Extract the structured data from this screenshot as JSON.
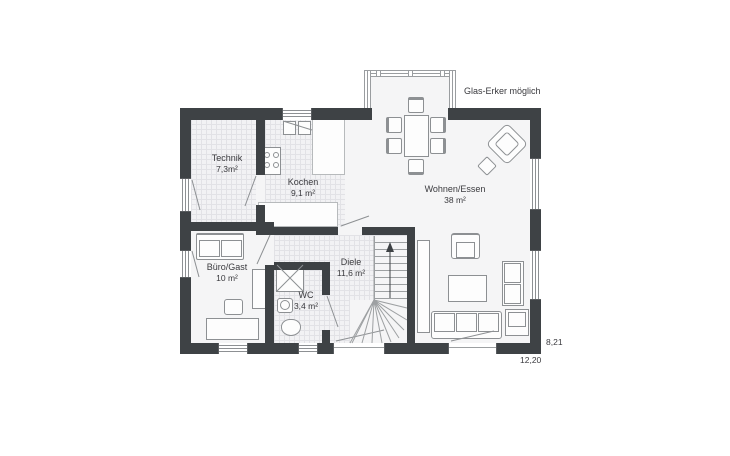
{
  "annotations": {
    "glas_erker_label": "Glas-Erker möglich",
    "dim_height": "8,21",
    "dim_width": "12,20"
  },
  "rooms": [
    {
      "name": "Technik",
      "area": "7,3m²"
    },
    {
      "name": "Kochen",
      "area": "9,1 m²"
    },
    {
      "name": "Wohnen/Essen",
      "area": "38 m²"
    },
    {
      "name": "Büro/Gast",
      "area": "10 m²"
    },
    {
      "name": "Diele",
      "area": "11,6 m²"
    },
    {
      "name": "WC",
      "area": "3,4 m²"
    }
  ],
  "colors": {
    "wall": "#3e4245",
    "floor": "#f5f5f6",
    "tile_floor": "#f2f2f4",
    "tile_line": "#e2e2e6",
    "furniture_outline": "#8d9093",
    "text": "#3a3a3e",
    "background": "#ffffff"
  }
}
